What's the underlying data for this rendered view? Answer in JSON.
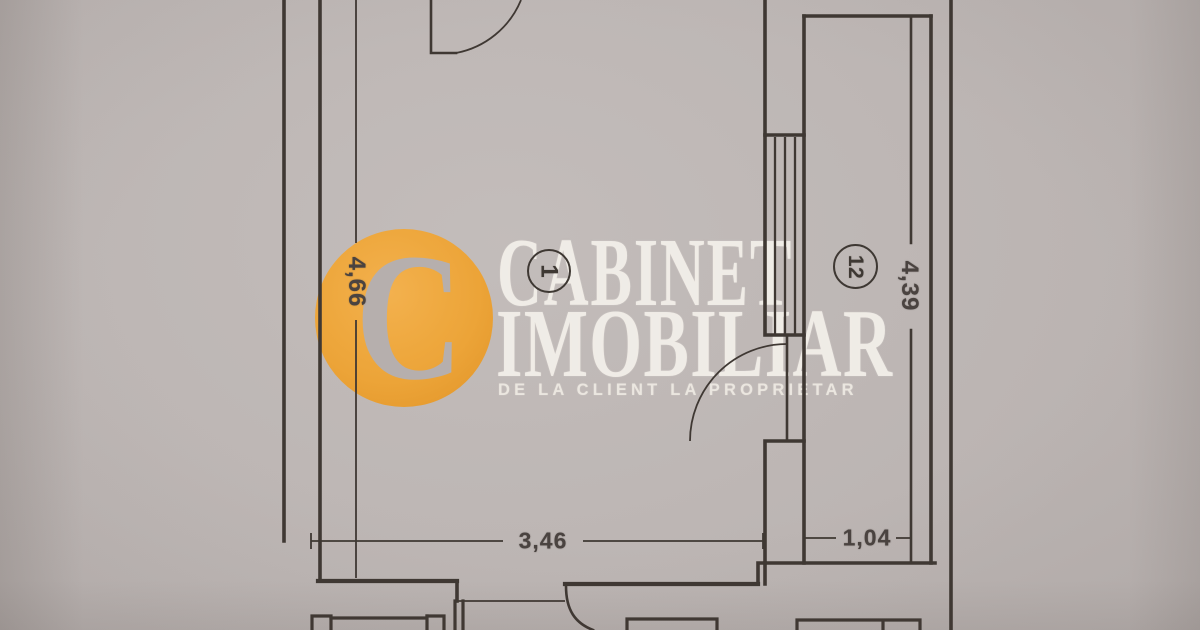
{
  "watermark": {
    "brand_line1": "CABINET",
    "brand_line2": "IMOBILIAR",
    "tagline": "DE LA CLIENT LA PROPRIETAR",
    "logo_letter": "C"
  },
  "plan": {
    "rooms": [
      {
        "id": "1"
      },
      {
        "id": "12"
      }
    ],
    "dimensions": [
      {
        "value": "4,66",
        "orientation": "vertical"
      },
      {
        "value": "4,39",
        "orientation": "vertical"
      },
      {
        "value": "3,46",
        "orientation": "horizontal"
      },
      {
        "value": "1,04",
        "orientation": "horizontal"
      }
    ]
  },
  "colors": {
    "line": "#3f3833",
    "dim-text": "#4a4340",
    "logo-orange": "#eea434",
    "watermark-text": "#f4f0ea",
    "paper": "#b2abaa"
  }
}
